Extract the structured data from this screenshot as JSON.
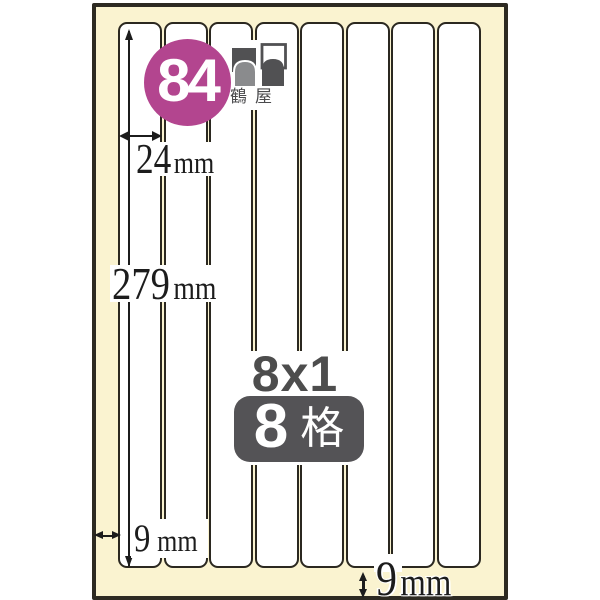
{
  "product": {
    "code": "84",
    "layout": "8x1",
    "cell_count": "8",
    "cell_unit": "格"
  },
  "brand": {
    "name": "鶴屋"
  },
  "sheet": {
    "label_count": 8,
    "label_width": {
      "value": "24",
      "unit": "mm"
    },
    "label_height": {
      "value": "279",
      "unit": "mm"
    },
    "left_margin": {
      "value": "9",
      "unit": "mm"
    },
    "bottom_margin": {
      "value": "9",
      "unit": "mm"
    }
  },
  "colors": {
    "background": "#ffffff",
    "sheet_fill": "#faf3d0",
    "outline": "#2d2a22",
    "accent_circle": "#b3458f",
    "badge_gray": "#545356",
    "text_gray": "#4d4d4d",
    "dimension_text": "#1c1c1c"
  }
}
